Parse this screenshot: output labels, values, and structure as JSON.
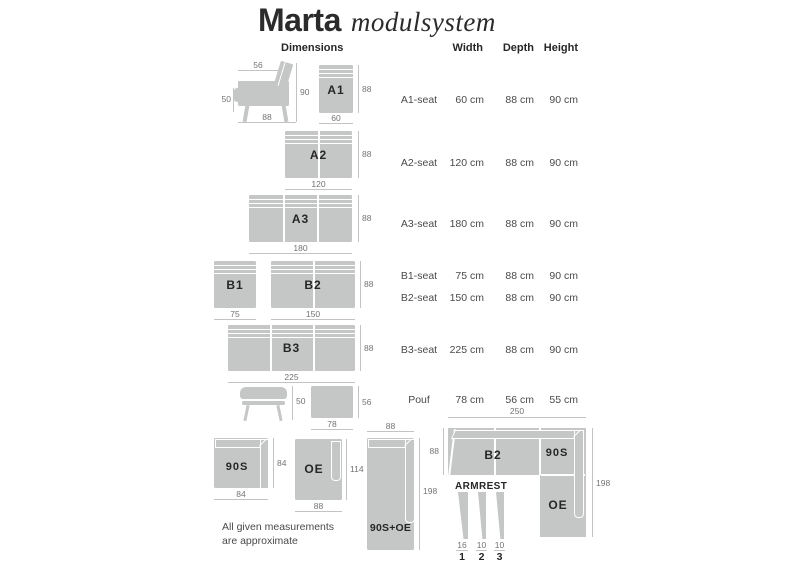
{
  "title": {
    "brand": "Marta",
    "suffix": "modulsystem"
  },
  "columns": {
    "dimensions": "Dimensions",
    "width": "Width",
    "depth": "Depth",
    "height": "Height"
  },
  "table": {
    "rows": [
      {
        "name": "A1-seat",
        "width": "60 cm",
        "depth": "88 cm",
        "height": "90 cm"
      },
      {
        "name": "A2-seat",
        "width": "120 cm",
        "depth": "88 cm",
        "height": "90 cm"
      },
      {
        "name": "A3-seat",
        "width": "180 cm",
        "depth": "88 cm",
        "height": "90 cm"
      },
      {
        "name": "B1-seat",
        "width": "75 cm",
        "depth": "88 cm",
        "height": "90 cm"
      },
      {
        "name": "B2-seat",
        "width": "150 cm",
        "depth": "88 cm",
        "height": "90 cm"
      },
      {
        "name": "B3-seat",
        "width": "225 cm",
        "depth": "88 cm",
        "height": "90 cm"
      },
      {
        "name": "Pouf",
        "width": "78 cm",
        "depth": "56 cm",
        "height": "55 cm"
      }
    ]
  },
  "modules": {
    "chair_side": {
      "dims": {
        "top": "56",
        "left": "50",
        "right": "90",
        "bottom": "88"
      }
    },
    "a1": {
      "label": "A1",
      "dims": {
        "right": "88",
        "bottom": "60"
      }
    },
    "a2": {
      "label": "A2",
      "dims": {
        "right": "88",
        "bottom": "120"
      }
    },
    "a3": {
      "label": "A3",
      "dims": {
        "right": "88",
        "bottom": "180"
      }
    },
    "b1": {
      "label": "B1",
      "dims": {
        "bottom": "75"
      }
    },
    "b2": {
      "label": "B2",
      "dims": {
        "right": "88",
        "bottom": "150"
      }
    },
    "b3": {
      "label": "B3",
      "dims": {
        "right": "88",
        "bottom": "225"
      }
    },
    "pouf_side": {
      "dims": {
        "right": "50"
      }
    },
    "pouf_top": {
      "dims": {
        "right": "56",
        "bottom": "78"
      }
    },
    "s90": {
      "label": "90S",
      "dims": {
        "right": "84",
        "bottom": "84"
      }
    },
    "oe": {
      "label": "OE",
      "dims": {
        "right": "114",
        "bottom": "88"
      }
    },
    "s90_oe": {
      "label": "90S+OE",
      "dims": {
        "top": "88",
        "right": "198"
      }
    },
    "corner_config": {
      "labels": {
        "b2": "B2",
        "s90": "90S",
        "oe": "OE"
      },
      "dims": {
        "top": "250",
        "left": "88",
        "right": "198"
      }
    }
  },
  "armrest": {
    "title": "ARMREST",
    "items": [
      {
        "size": "16",
        "index": "1"
      },
      {
        "size": "10",
        "index": "2"
      },
      {
        "size": "10",
        "index": "3"
      }
    ]
  },
  "footnote": {
    "line1": "All given measurements",
    "line2": "are approximate"
  },
  "colors": {
    "module_fill": "#c5c6c6",
    "dim_line": "#c3c3c3",
    "dim_text": "#737373",
    "label_text": "#262626",
    "table_text": "#4a4a4a"
  }
}
